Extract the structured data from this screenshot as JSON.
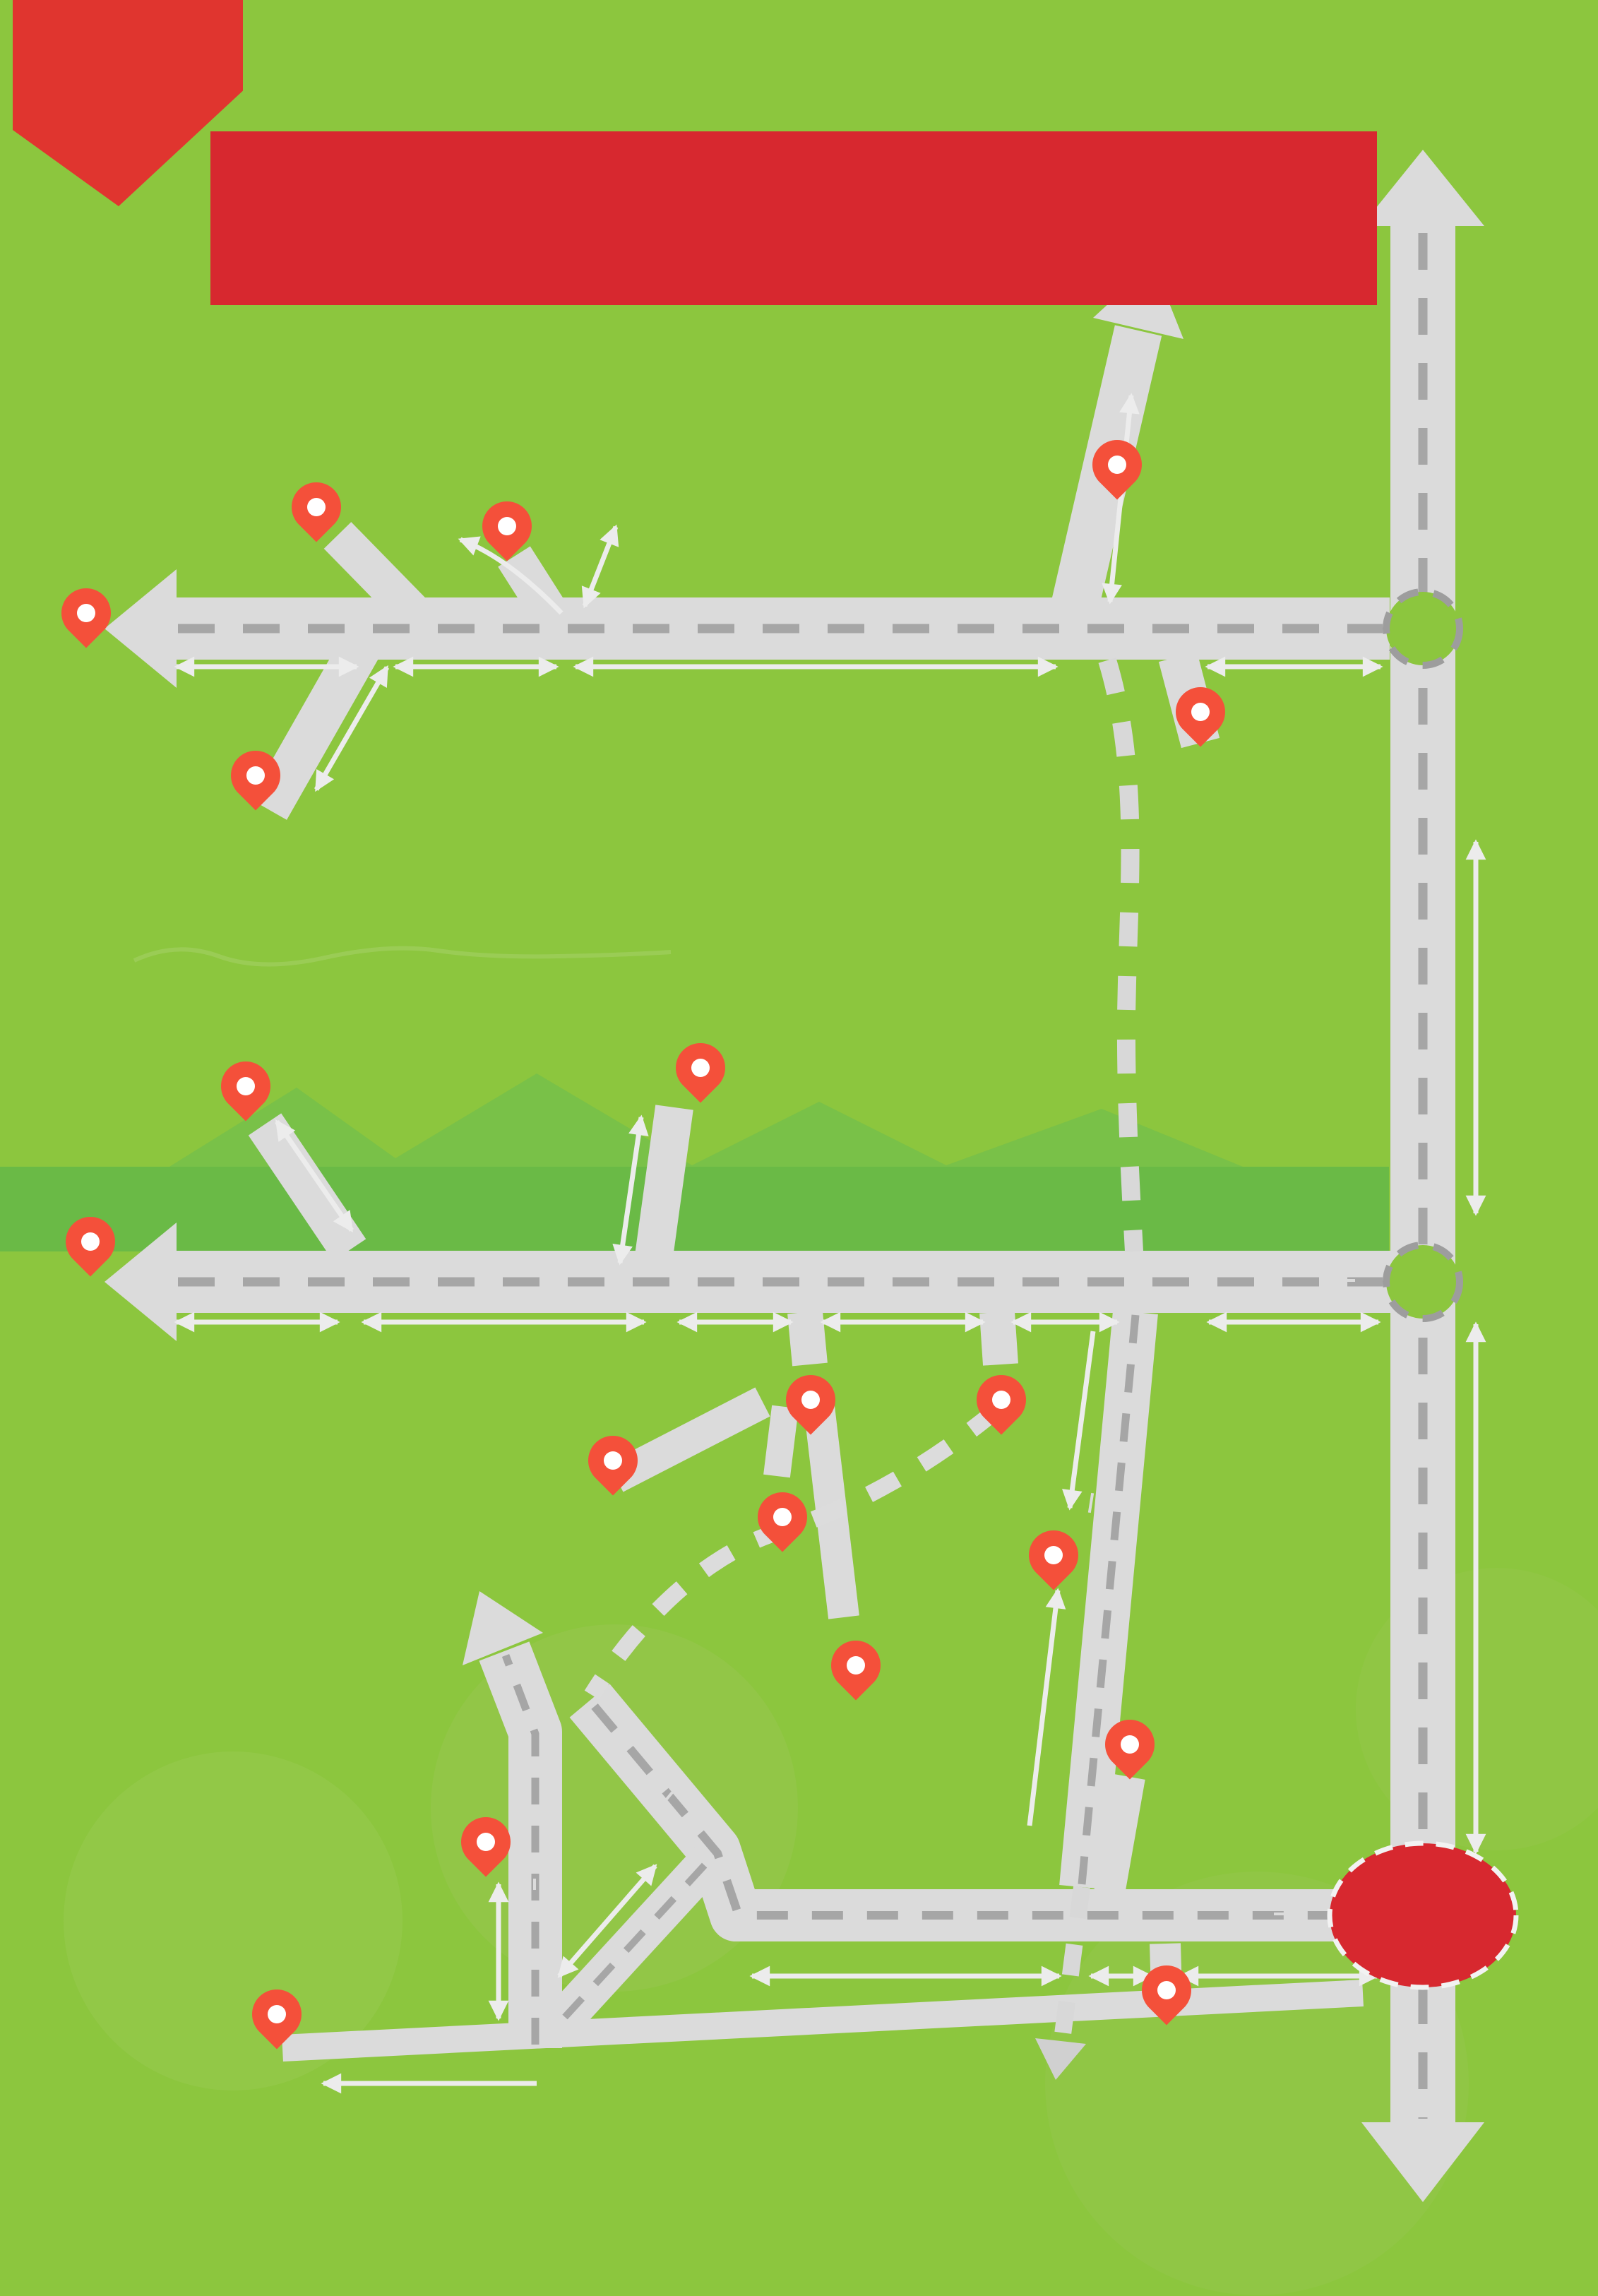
{
  "banner": {
    "line1": "SƠ ĐỒ HƯỚNG DẪN ĐẾN CÁC ĐIỂM DU LỊCH",
    "line2": "TIÊU BIỂU MIỀN TÂY, NGHỆ AN"
  },
  "colors": {
    "background": "#8CC63E",
    "banner_red": "#D7282F",
    "pin_red": "#F4503A",
    "road_gray": "#DBDBDB",
    "dash_gray": "#A6A6A6",
    "distance_green": "#567A40",
    "label_black": "#1D1D1B"
  },
  "map": {
    "roads": {
      "ql48a": "QL48A",
      "ql7": "QL7",
      "ql1a": "QL1A",
      "ql15": "QL15",
      "ql46a_diag": "QL46A",
      "ql46a": "QL46A",
      "ql46c": "QL46C",
      "dt543": "ĐT543",
      "hcm_top": "ĐƯỜNG HỒ CHÍ MINH",
      "hcm_bottom": "ĐƯỜNG HỒ CHÍ MINH"
    },
    "junctions": {
      "yen_ly": {
        "line1": "Ngã ba",
        "line2": "Yên Lý"
      },
      "dien_chau": {
        "line1": "TT Diễn",
        "line2": "Châu"
      },
      "tp_vinh": "TP VINH"
    },
    "locations": {
      "thac_xao_va": {
        "line1": "Thác Xao Va",
        "line2": "Quế Phong"
      },
      "hoa_tien": {
        "line1": "Bản du lịch cộng đồng",
        "line2": "Hoa Tiến, Quỳ Châu"
      },
      "canh_dong": {
        "line1": "Cánh đồng",
        "line2": "Hoa hướng dương,",
        "line3": "Nghĩa Đàn"
      },
      "thong_thu": {
        "line1": "Cửa khẩu",
        "line2": "quốc gia",
        "line3": "Thông Thụ"
      },
      "den_chin_gian": {
        "line1": "Đền Chín Gian",
        "line2": "Quế Phong"
      },
      "muong_thanh": {
        "line1": "Khu du lịch sinh thái",
        "line2": "Mường Thanh Diễn Lâm"
      },
      "muong_long": {
        "line1": "Mường Lồng,",
        "line2": "Kỳ Sơn"
      },
      "rung_sang_le": {
        "line1": "Rừng Săng lẻ",
        "line2": "Tương Dương"
      },
      "nam_can": {
        "line1": "Cửa khẩu",
        "line2": "quốc tế",
        "line3": "Nậm Cắn"
      },
      "pu_mat": {
        "line1": "Vườn Quốc gia",
        "line2": "Pù Mát"
      },
      "nghia_trang": {
        "line1": "Nghĩa trang liệt sĩ",
        "line2": "Việt - Lào"
      },
      "khe_kem": {
        "line1": "Thác Khe Kèm"
      },
      "ban_nua": {
        "line1": "Du lịch cộng đồng",
        "line2": "bản Nưa"
      },
      "pha_lai": {
        "line1": "Khu DL sinh thái",
        "line2": "Pha Lài"
      },
      "truong_bon": {
        "line1": "Khu di tích",
        "line2": "Truông Bồn"
      },
      "chua_dai_tue": {
        "line1": "Chùa",
        "line2": "Đại Tuệ"
      },
      "que_bac": {
        "line1": "Quê Bác",
        "line2": "Nam Đàn"
      },
      "thanh_thuy": {
        "line1": "Cửa khẩu quốc gia",
        "line2": "Thanh Thủy"
      },
      "dao_che": {
        "line1": "Đào chè",
        "line2": "Thanh Chương"
      }
    },
    "distances": {
      "d41": "41km",
      "d65_48a": "6,5km",
      "d110": "110km",
      "d15_48a": "15km",
      "d35_spur": "3,5km",
      "d2": "2km",
      "d13": "13km",
      "d10": "10km",
      "d15_ql1a": "15km",
      "d38": "38km",
      "d19_ql7": "19km",
      "d70": "70km",
      "d40": "40km",
      "d33": "33km",
      "d27": "27km",
      "d35_ql7": "35km",
      "d44": "44km",
      "d42": "42km",
      "d20": "20km",
      "d7": "7km",
      "d22_nua": "22km",
      "d19_ql15": "19km",
      "d15_ql15": "15km",
      "d12": "12km",
      "d16": "16km",
      "d8": "8km",
      "d14": "14km",
      "d11": "11km",
      "d65_hcm": "6,5km",
      "d22_bottom": "22km"
    }
  },
  "footer": {
    "brand": "DU LỊCH NGHỆ AN",
    "divider": "|",
    "page": "23"
  }
}
